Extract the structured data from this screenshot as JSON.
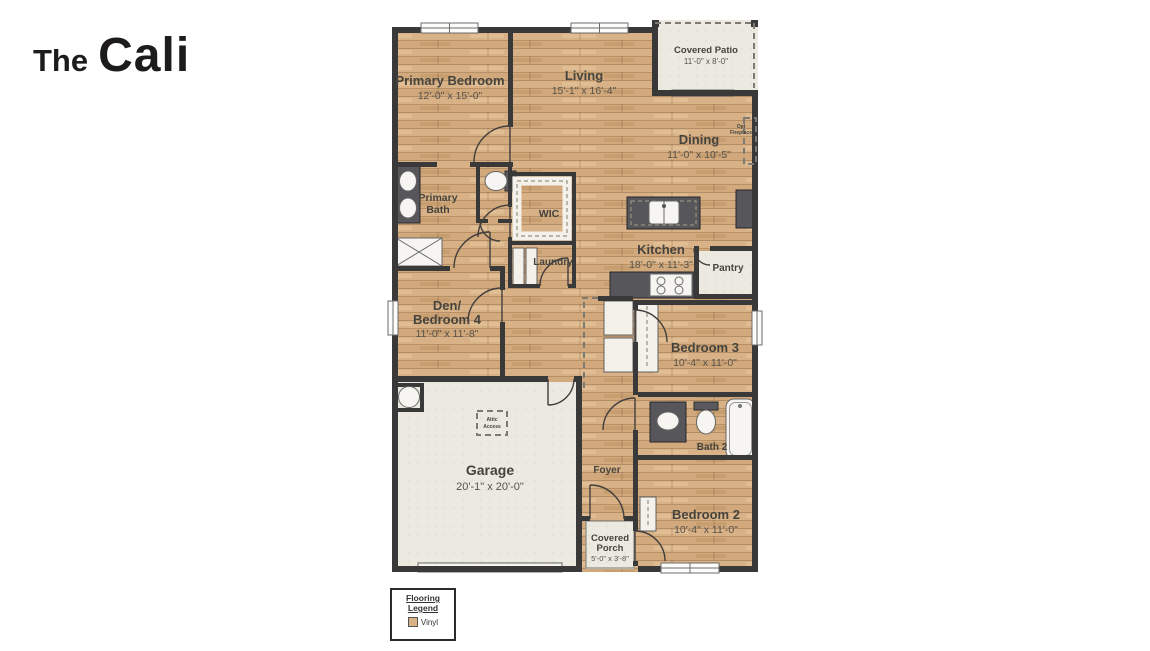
{
  "title": {
    "prefix": "The",
    "name": "Cali"
  },
  "plan": {
    "rooms": {
      "primary_bedroom": {
        "label": "Primary Bedroom",
        "dims": "12'-0\" x 15'-0\""
      },
      "living": {
        "label": "Living",
        "dims": "15'-1\" x 16'-4\""
      },
      "covered_patio": {
        "label": "Covered Patio",
        "dims": "11'-0\" x 8'-0\""
      },
      "dining": {
        "label": "Dining",
        "dims": "11'-0\" x 10'-5\""
      },
      "primary_bath": {
        "label_line1": "Primary",
        "label_line2": "Bath"
      },
      "wic": {
        "label": "WIC"
      },
      "laundry": {
        "label": "Laundry"
      },
      "kitchen": {
        "label": "Kitchen",
        "dims": "18'-0\" x 11'-3\""
      },
      "pantry": {
        "label": "Pantry"
      },
      "den_bedroom4": {
        "label_line1": "Den/",
        "label_line2": "Bedroom 4",
        "dims": "11'-0\" x 11'-8\""
      },
      "bedroom3": {
        "label": "Bedroom 3",
        "dims": "10'-4\" x 11'-0\""
      },
      "bath2": {
        "label": "Bath 2"
      },
      "garage": {
        "label": "Garage",
        "dims": "20'-1\" x 20'-0\""
      },
      "foyer": {
        "label": "Foyer"
      },
      "covered_porch": {
        "label_line1": "Covered",
        "label_line2": "Porch",
        "dims": "5'-0\" x 3'-8\""
      },
      "bedroom2": {
        "label": "Bedroom 2",
        "dims": "10'-4\" x 11'-0\""
      }
    },
    "annotations": {
      "attic_line1": "Attic",
      "attic_line2": "Access",
      "fireplace_line1": "Opt",
      "fireplace_line2": "Fireplace"
    }
  },
  "legend": {
    "title_line1": "Flooring",
    "title_line2": "Legend",
    "item_label": "Vinyl",
    "swatch_color": "#d8b286"
  },
  "colors": {
    "wood_floor": "#d8b286",
    "wall": "#3a393a",
    "light_floor": "#ebe9e0",
    "counter": "#57575b"
  }
}
